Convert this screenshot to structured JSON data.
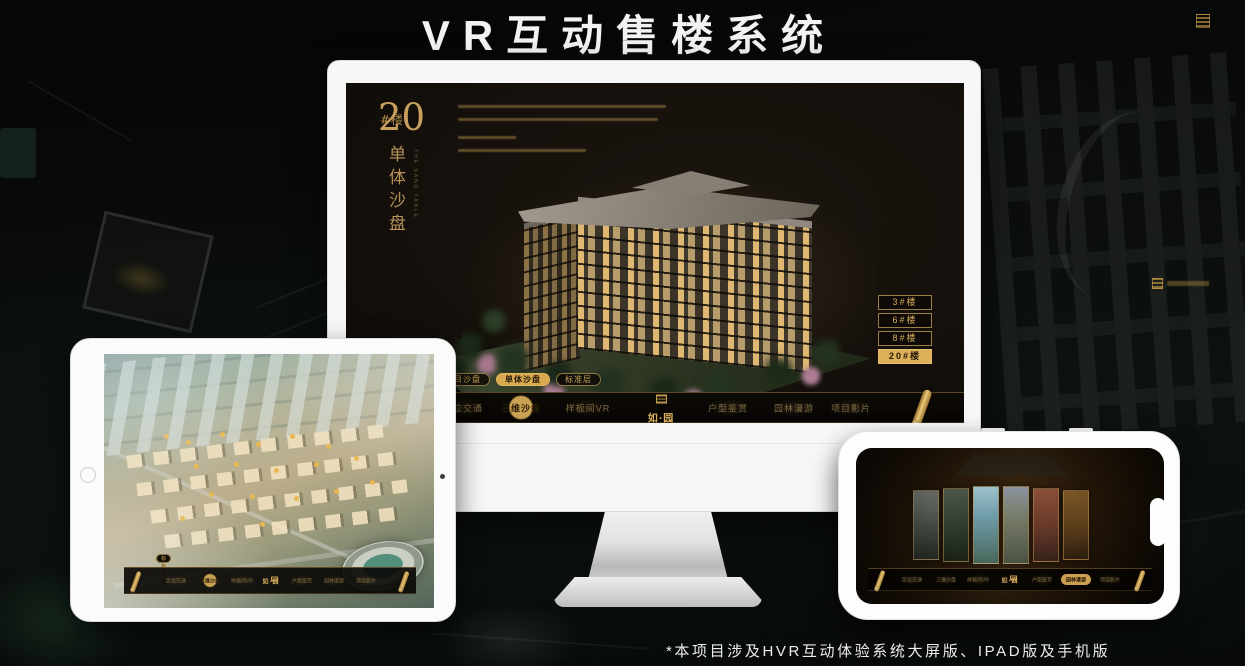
{
  "page": {
    "title": "VR互动售楼系统",
    "footnote": "*本项目涉及HVR互动体验系统大屏版、IPAD版及手机版"
  },
  "colors": {
    "gold": "#CFA45C",
    "gold_active": "#DDB05A",
    "screen_bg": "#17120D",
    "device_white": "#F7F7F8"
  },
  "monitor": {
    "heading": {
      "number": "20",
      "suffix": "#楼",
      "vertical_title": "单体沙盘",
      "vertical_subtitle": "THE SAND TABLE"
    },
    "floor_buttons": [
      {
        "label": "3#楼",
        "active": false
      },
      {
        "label": "6#楼",
        "active": false
      },
      {
        "label": "8#楼",
        "active": false
      },
      {
        "label": "20#楼",
        "active": true
      }
    ],
    "sub_tabs": [
      {
        "label": "项目沙盘",
        "active": false
      },
      {
        "label": "单体沙盘",
        "active": true
      },
      {
        "label": "标准层",
        "active": false
      }
    ],
    "nav": {
      "logo": "如·园",
      "items": [
        {
          "label": "区位交通",
          "active": false
        },
        {
          "label": "三维沙盘",
          "active": true
        },
        {
          "label": "样板间VR",
          "active": false
        },
        {
          "label": "户型鉴赏",
          "active": false
        },
        {
          "label": "园林漫游",
          "active": false
        },
        {
          "label": "项目影片",
          "active": false
        }
      ]
    }
  },
  "tablet": {
    "sub_tabs": [
      {
        "label": "项目沙盘",
        "active": true
      },
      {
        "label": "单体沙盘",
        "active": false
      },
      {
        "label": "标准层",
        "active": false
      }
    ],
    "nav": {
      "logo": "如·园",
      "items": [
        {
          "label": "区位交通",
          "active": false
        },
        {
          "label": "三维沙盘",
          "active": true
        },
        {
          "label": "样板间VR",
          "active": false
        },
        {
          "label": "户型鉴赏",
          "active": false
        },
        {
          "label": "园林漫游",
          "active": false
        },
        {
          "label": "项目影片",
          "active": false
        }
      ]
    }
  },
  "phone": {
    "nav": {
      "logo": "如·园",
      "items": [
        {
          "label": "区位交通",
          "active": false
        },
        {
          "label": "三维沙盘",
          "active": false
        },
        {
          "label": "样板间VR",
          "active": false
        },
        {
          "label": "户型鉴赏",
          "active": false
        },
        {
          "label": "园林漫游",
          "active": true
        },
        {
          "label": "项目影片",
          "active": false
        }
      ]
    }
  }
}
